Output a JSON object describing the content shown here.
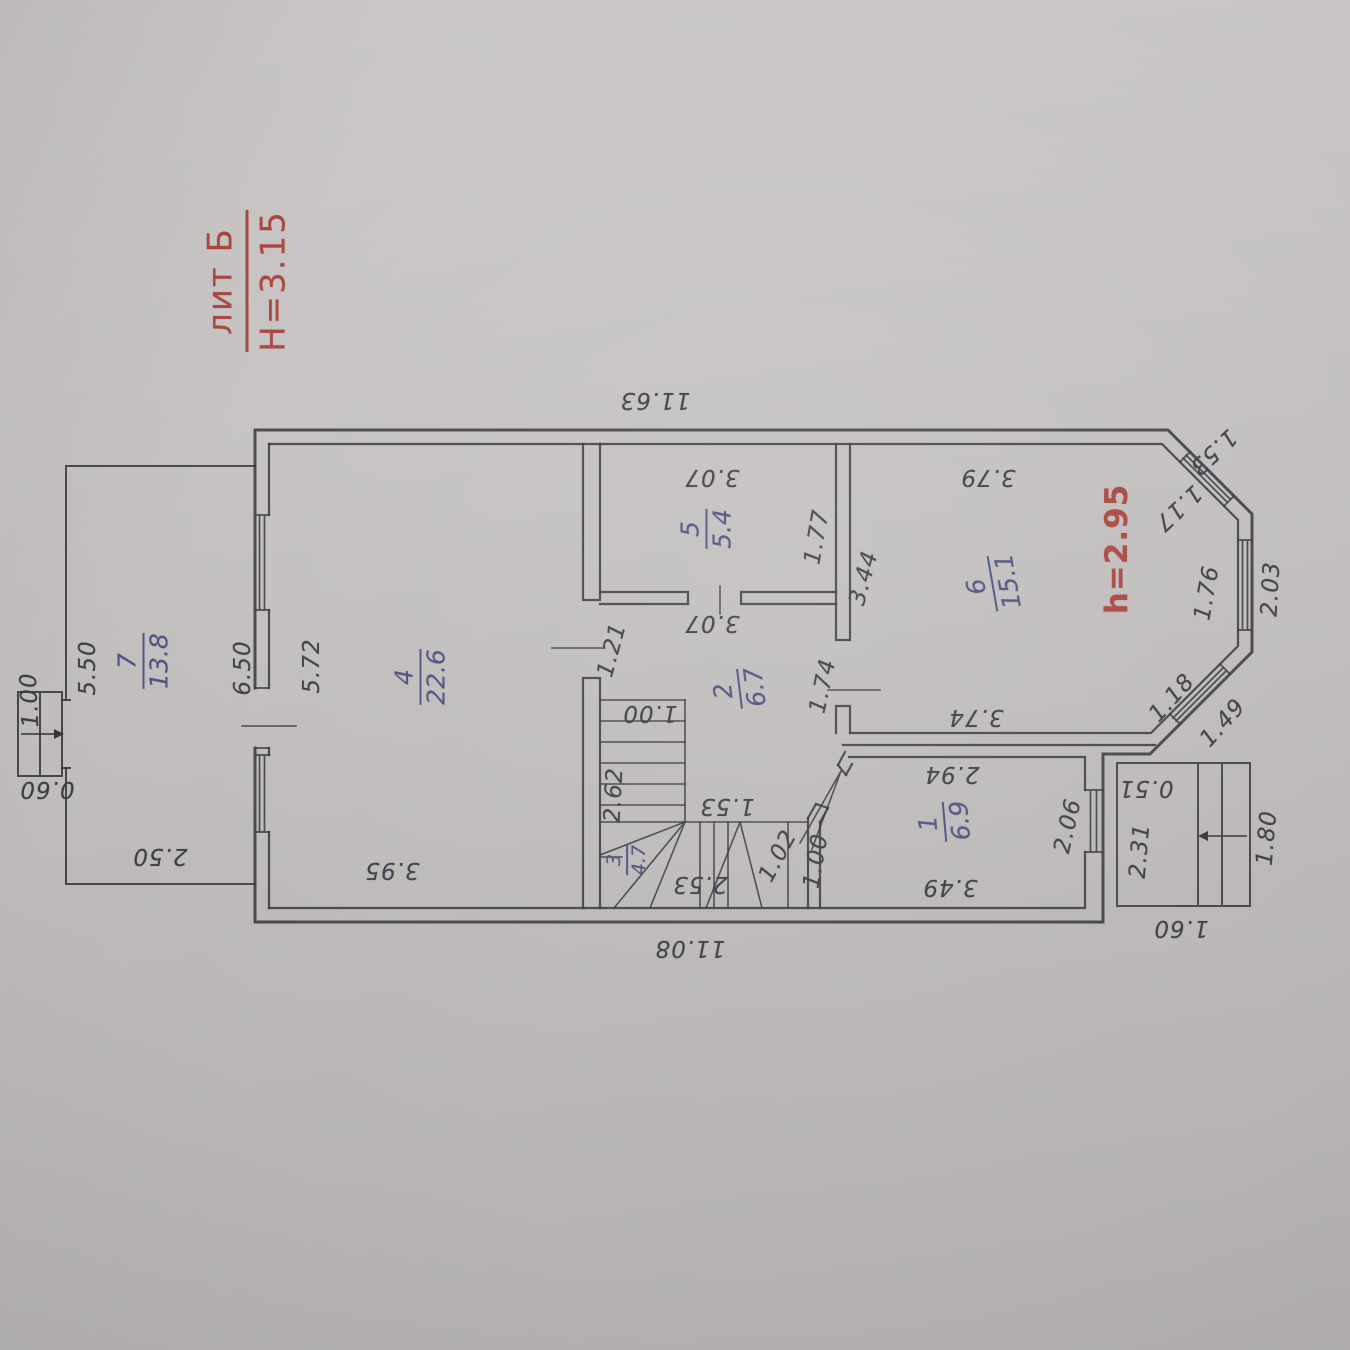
{
  "plan": {
    "liter_label": "лит Б",
    "floor_height": "H=3.15",
    "room_height_note": "h=2.95"
  },
  "rooms": [
    {
      "num": "1",
      "area": "6.9"
    },
    {
      "num": "2",
      "area": "6.7"
    },
    {
      "num": "3",
      "area": "4.7"
    },
    {
      "num": "4",
      "area": "22.6"
    },
    {
      "num": "5",
      "area": "5.4"
    },
    {
      "num": "6",
      "area": "15.1"
    },
    {
      "num": "7",
      "area": "13.8"
    }
  ],
  "dims": {
    "outer_top": "11.63",
    "outer_bottom": "11.08",
    "annex_side": "5.50",
    "annex_width": "2.50",
    "annex_wall": "6.50",
    "porch_left_depth": "1.00",
    "porch_left_width": "0.60",
    "room4_side": "5.72",
    "room4_width": "3.95",
    "room5_width": "3.07",
    "room5_right": "1.77",
    "room2_width": "3.07",
    "room2_left": "1.21",
    "room2_right": "1.74",
    "stairs_width": "1.00",
    "stairs_length": "2.62",
    "stairs_landing": "1.53",
    "stairs_bottom": "2.53",
    "stairs_door": "1.02",
    "stairs_corridor": "1.00",
    "room6_top": "3.79",
    "room6_left": "3.44",
    "room6_bottom": "3.74",
    "bay_top_outer": "1.53",
    "bay_top_inner": "1.17",
    "bay_right_inner": "1.76",
    "bay_right_outer": "2.03",
    "bay_bottom_inner": "1.18",
    "bay_bottom_outer": "1.49",
    "room1_top": "2.94",
    "room1_right": "2.06",
    "room1_bottom": "3.49",
    "porch_right_step": "0.51",
    "porch_right_depth": "2.31",
    "porch_right_side": "1.80",
    "porch_right_width": "1.60"
  }
}
